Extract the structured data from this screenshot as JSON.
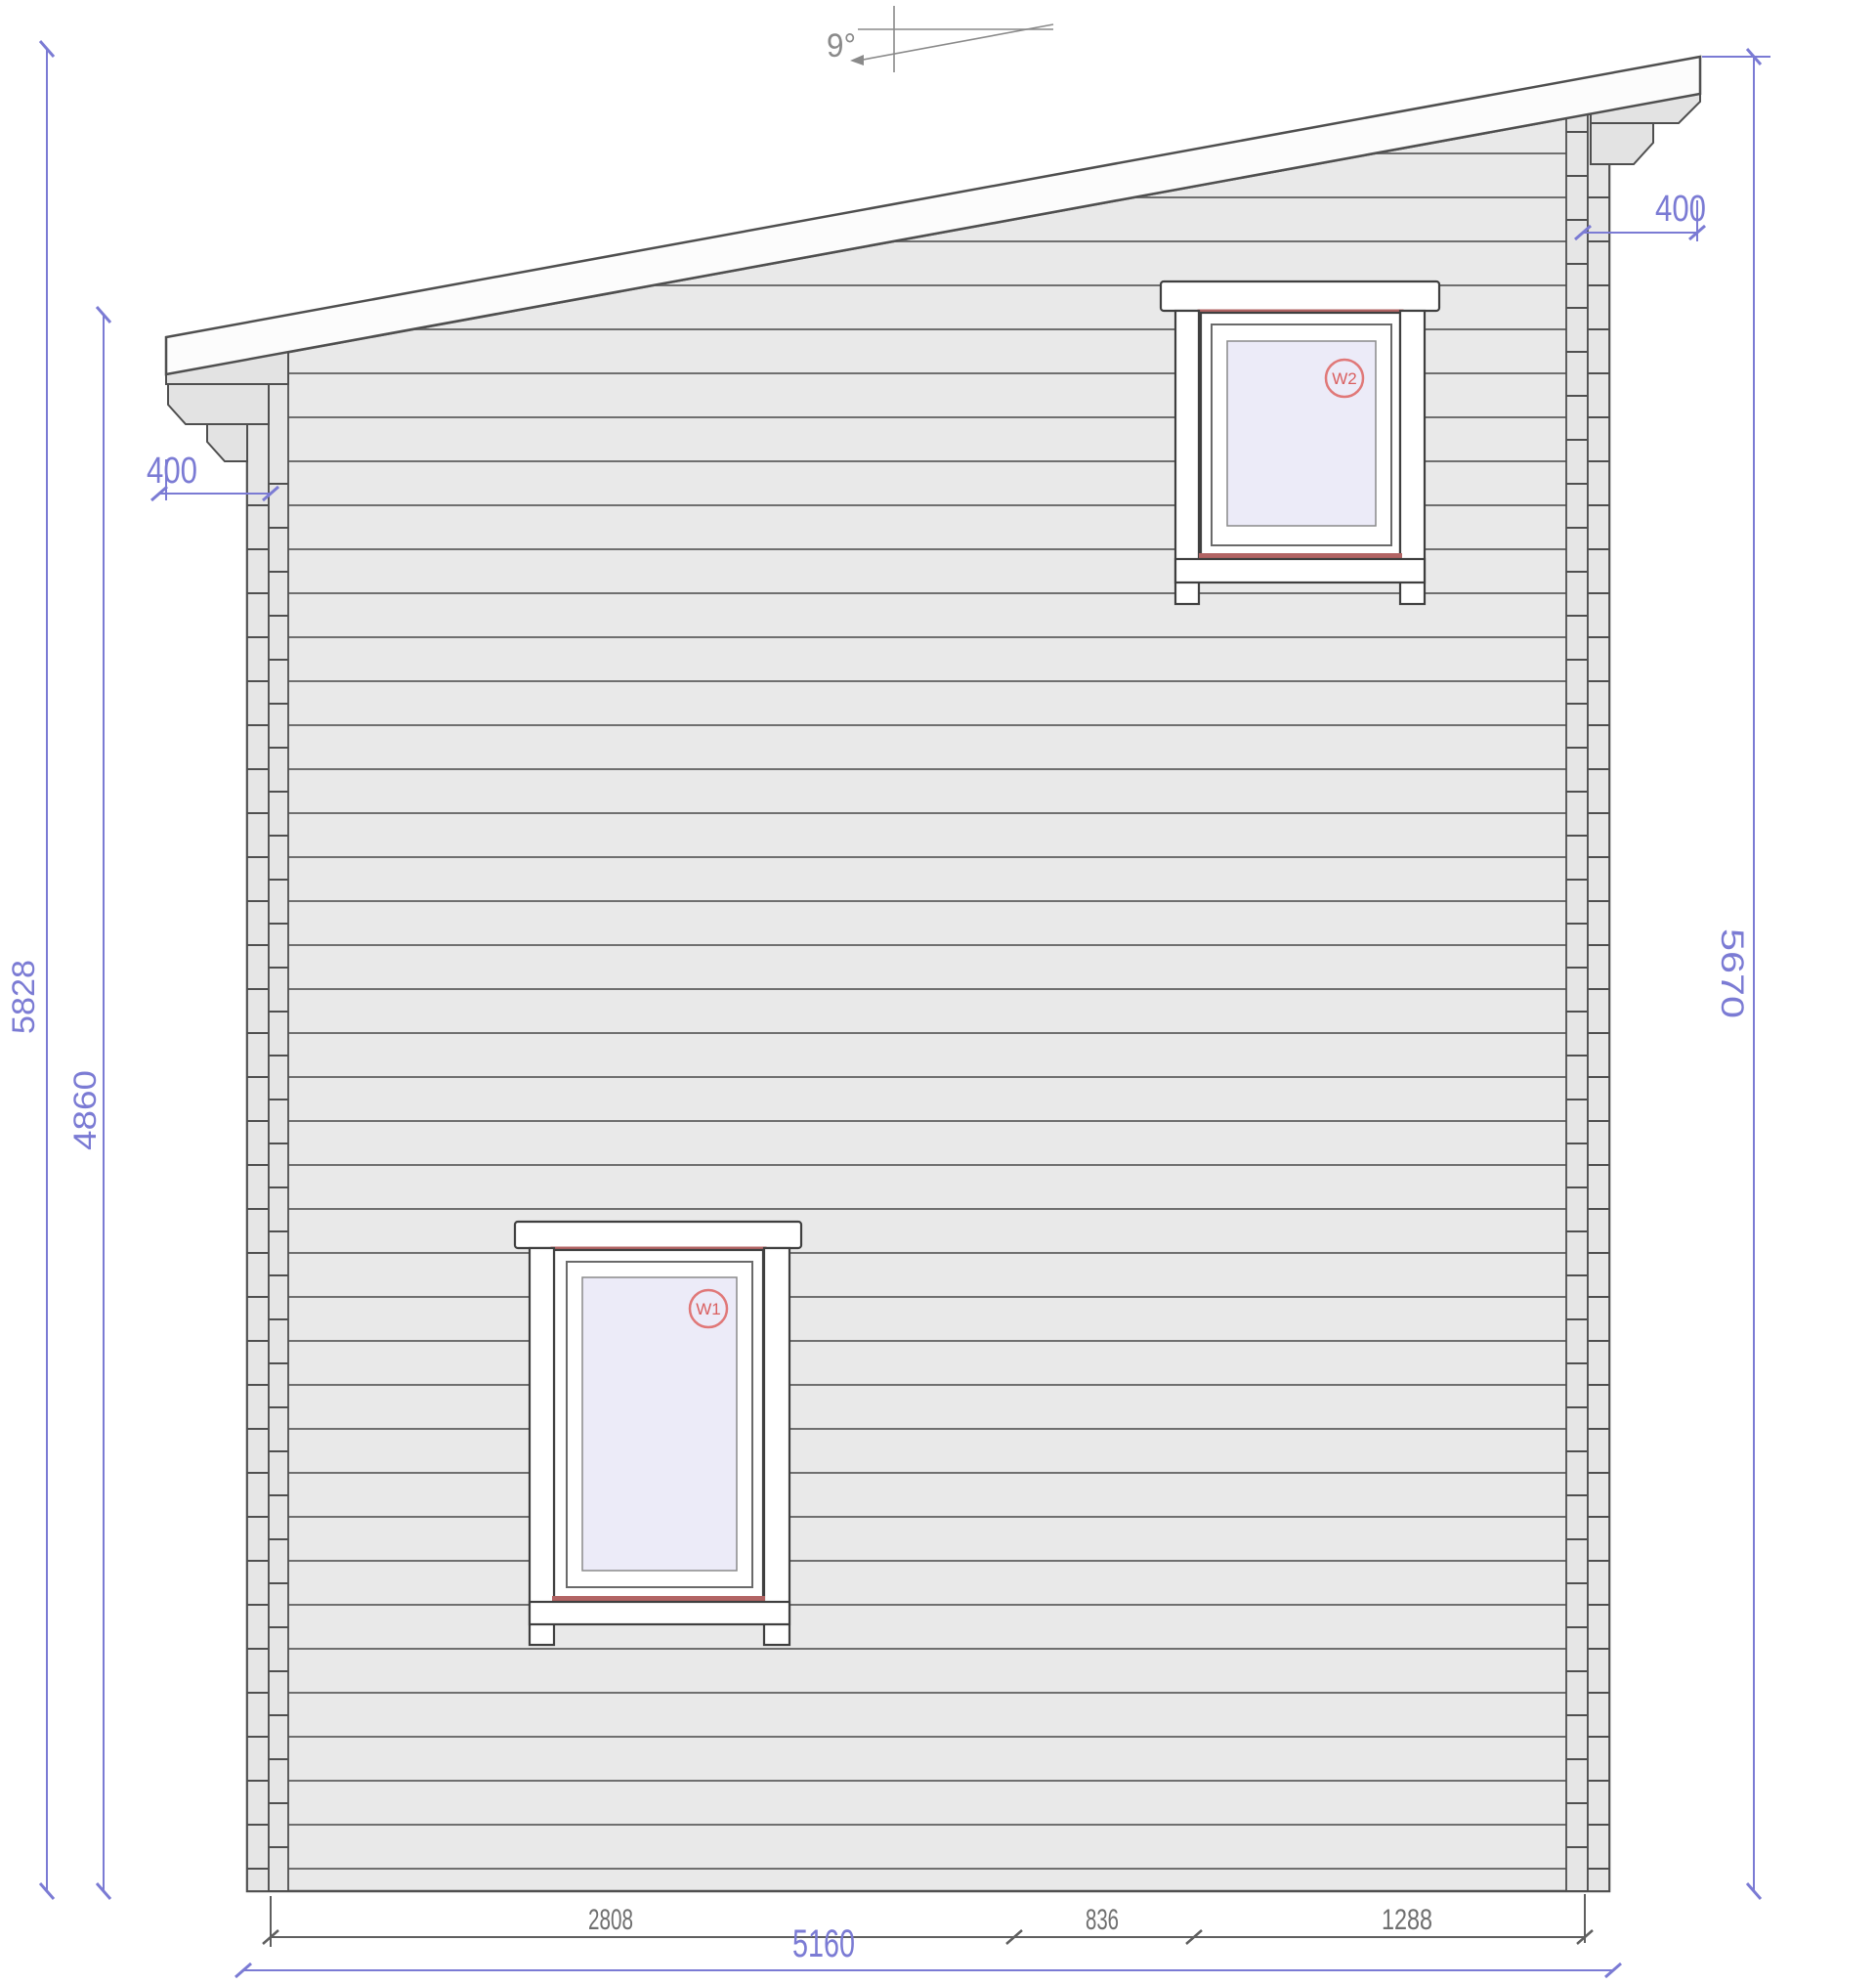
{
  "drawing": {
    "type": "side-elevation-plan",
    "annotation": {
      "roof_angle": "9°"
    },
    "dimensions": {
      "total_height": "5828",
      "left_wall_height": "4860",
      "right_wall_height": "5670",
      "left_overhang": "400",
      "right_overhang": "400",
      "bottom_segment_1": "2808",
      "bottom_segment_2": "836",
      "bottom_segment_3": "1288",
      "total_width": "5160"
    },
    "windows": {
      "w1": {
        "label": "W1"
      },
      "w2": {
        "label": "W2"
      }
    },
    "colors": {
      "dimension_accent": "#7b7bd4",
      "secondary_dimension_gray": "#6f6f6f",
      "drawing_line": "#4f4f4f",
      "window_frame_red": "#b26464",
      "window_badge_red": "#d95f5f",
      "wall_fill": "#e9e9e9",
      "glass_fill": "#ecebf8",
      "roof_fill": "#fcfcfc"
    }
  }
}
